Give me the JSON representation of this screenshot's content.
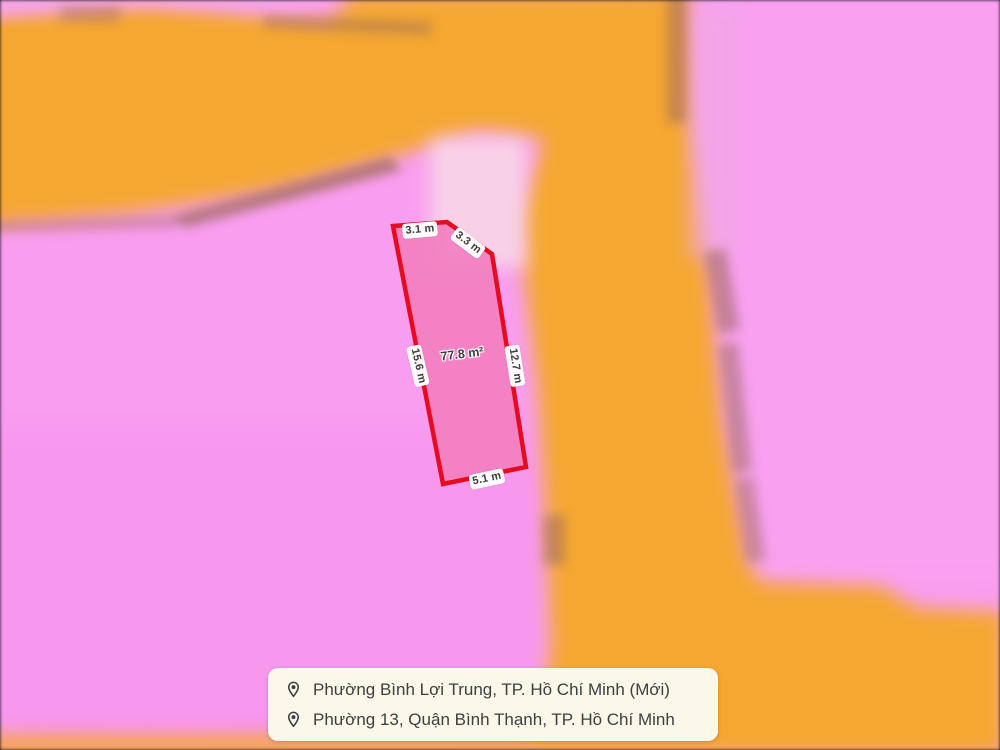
{
  "map": {
    "parcel": {
      "area_label": "77.8 m²",
      "measurements": {
        "top": "3.1 m",
        "top_right": "3.3 m",
        "left": "15.6 m",
        "right": "12.7 m",
        "bottom": "5.1 m"
      }
    },
    "colors": {
      "pink_base": "#f99df0",
      "orange_road": "#f5a733",
      "pale_strip": "#f8dbe7",
      "road_edge_maroon": "#9a685c",
      "parcel_fill": "#f27fc0",
      "parcel_stroke": "#e60b1e"
    }
  },
  "location_panel": {
    "background": "#fbf7e9",
    "items": [
      {
        "icon": "location-pin-icon",
        "label": "Phường Bình Lợi Trung, TP. Hồ Chí Minh (Mới)"
      },
      {
        "icon": "location-pin-icon",
        "label": "Phường 13, Quận Bình Thạnh, TP. Hồ Chí Minh"
      }
    ]
  }
}
